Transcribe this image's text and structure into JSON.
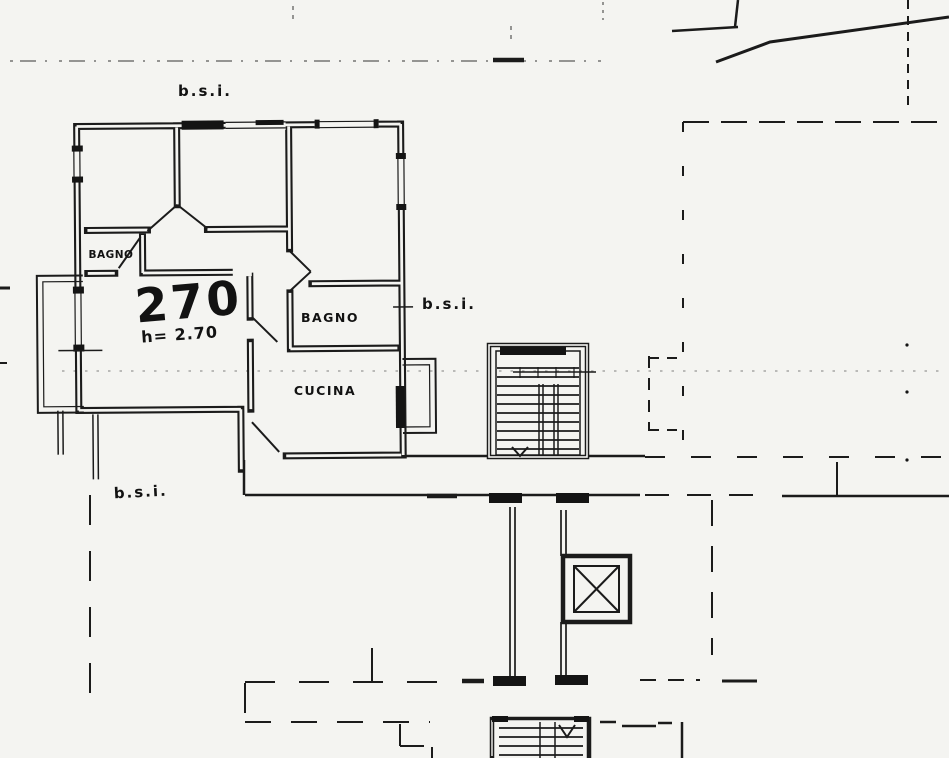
{
  "plan": {
    "labels": {
      "bsi_top": "b.s.i.",
      "bsi_middle": "b.s.i.",
      "bsi_bottom": "b.s.i.",
      "bathroom_small": "BAGNO",
      "bathroom_main": "BAGNO",
      "kitchen": "CUCINA",
      "unit_number": "270",
      "ceiling_height": "h= 2.70"
    },
    "colors": {
      "ink": "#1b1b1b",
      "paper": "#f4f4f1"
    }
  }
}
